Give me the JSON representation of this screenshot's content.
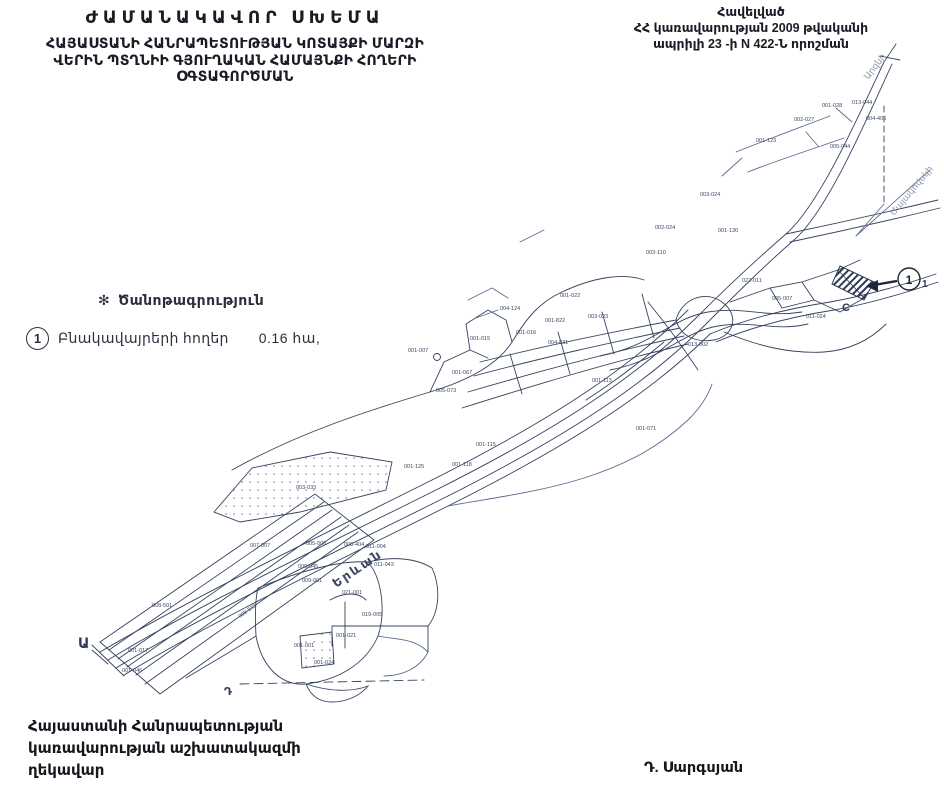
{
  "header": {
    "title_lines": [
      "ԺԱՄԱՆԱԿԱՎՈՐ ՍԽԵՄԱ",
      "ՀԱՅԱՍՏԱՆԻ ՀԱՆՐԱՊԵՏՈՒԹՅԱՆ ԿՈՏԱՅՔԻ ՄԱՐԶԻ",
      "ՎԵՐԻՆ ՊՏՂՆԻԻ ԳՅՈՒՂԱԿԱՆ ՀԱՄԱՅՆՔԻ ՀՈՂԵՐԻ",
      "ՕԳՏԱԳՈՐԾՄԱՆ"
    ]
  },
  "approval": {
    "lines": [
      "Հավելված",
      "ՀՀ կառավարության 2009 թվականի",
      "ապրիլի 23 -ի N 422-Ն որոշման"
    ]
  },
  "legend": {
    "note_symbol": "✻",
    "note_title": "Ծանոթագրություն",
    "item_marker": "1",
    "item_label": "Բնակավայրերի հողեր",
    "item_value": "0.16 հա,"
  },
  "footer": {
    "left_lines": [
      "Հայաստանի Հանրապետության",
      "կառավարության աշխատակազմի",
      "ղեկավար"
    ],
    "signature": "Դ. Սարգսյան"
  },
  "map": {
    "ink_color": "#36435f",
    "light_ink_color": "#7484a6",
    "labels": [
      {
        "text": "Երևան",
        "x": 336,
        "y": 588,
        "rot": -34,
        "size": 12.5,
        "color": "#3c4560",
        "ls": 2,
        "weight": "600"
      },
      {
        "text": "Ա",
        "x": 78,
        "y": 648,
        "size": 14,
        "color": "#2e3a55",
        "weight": "600"
      },
      {
        "text": "Դ",
        "x": 224,
        "y": 695,
        "size": 11,
        "color": "#2e3a55",
        "weight": "600"
      },
      {
        "text": "C",
        "x": 842,
        "y": 311,
        "size": 11,
        "color": "#2e3a55",
        "weight": "600"
      },
      {
        "text": "1",
        "x": 909,
        "y": 284,
        "size": 12,
        "color": "#1d2638",
        "weight": "700",
        "anchor": "middle"
      },
      {
        "text": "1",
        "x": 922,
        "y": 287,
        "size": 10,
        "color": "#2e3a55",
        "weight": "600"
      },
      {
        "text": "Արզնի",
        "x": 868,
        "y": 80,
        "rot": -52,
        "size": 9,
        "color": "#8a97b5"
      },
      {
        "text": "Մայակովսկի",
        "x": 894,
        "y": 216,
        "rot": -50,
        "size": 9,
        "color": "#8a97b5"
      }
    ],
    "parcel_codes": [
      {
        "t": "001-123",
        "x": 756,
        "y": 142
      },
      {
        "t": "002-027",
        "x": 794,
        "y": 121
      },
      {
        "t": "001-028",
        "x": 822,
        "y": 107
      },
      {
        "t": "013-044",
        "x": 852,
        "y": 104
      },
      {
        "t": "005-044",
        "x": 830,
        "y": 148
      },
      {
        "t": "004-405",
        "x": 866,
        "y": 120
      },
      {
        "t": "003-024",
        "x": 700,
        "y": 196
      },
      {
        "t": "001-130",
        "x": 718,
        "y": 232
      },
      {
        "t": "002-024",
        "x": 655,
        "y": 229
      },
      {
        "t": "003-110",
        "x": 646,
        "y": 254
      },
      {
        "t": "001-022",
        "x": 560,
        "y": 297
      },
      {
        "t": "001-822",
        "x": 545,
        "y": 322
      },
      {
        "t": "003-023",
        "x": 588,
        "y": 318
      },
      {
        "t": "004-031",
        "x": 548,
        "y": 344
      },
      {
        "t": "001-016",
        "x": 516,
        "y": 334
      },
      {
        "t": "001-015",
        "x": 470,
        "y": 340
      },
      {
        "t": "004-124",
        "x": 500,
        "y": 310
      },
      {
        "t": "005-073",
        "x": 436,
        "y": 392
      },
      {
        "t": "001-007",
        "x": 408,
        "y": 352
      },
      {
        "t": "001-067",
        "x": 452,
        "y": 374
      },
      {
        "t": "001-113",
        "x": 592,
        "y": 382
      },
      {
        "t": "013-002",
        "x": 688,
        "y": 346
      },
      {
        "t": "022-011",
        "x": 742,
        "y": 282
      },
      {
        "t": "005-007",
        "x": 772,
        "y": 300
      },
      {
        "t": "011-024",
        "x": 806,
        "y": 318
      },
      {
        "t": "001-071",
        "x": 636,
        "y": 430
      },
      {
        "t": "001-115",
        "x": 476,
        "y": 446
      },
      {
        "t": "001-118",
        "x": 452,
        "y": 466
      },
      {
        "t": "001-125",
        "x": 404,
        "y": 468
      },
      {
        "t": "003-033",
        "x": 296,
        "y": 489
      },
      {
        "t": "008-533",
        "x": 240,
        "y": 618,
        "rot": -35
      },
      {
        "t": "008-501",
        "x": 152,
        "y": 607
      },
      {
        "t": "001-017",
        "x": 128,
        "y": 652
      },
      {
        "t": "001-046",
        "x": 122,
        "y": 672
      },
      {
        "t": "005-006",
        "x": 306,
        "y": 545
      },
      {
        "t": "008-404",
        "x": 344,
        "y": 546
      },
      {
        "t": "007-007",
        "x": 250,
        "y": 547
      },
      {
        "t": "009-045",
        "x": 298,
        "y": 568
      },
      {
        "t": "009-001",
        "x": 302,
        "y": 582
      },
      {
        "t": "011-004",
        "x": 366,
        "y": 548
      },
      {
        "t": "011-043",
        "x": 374,
        "y": 566
      },
      {
        "t": "021-001",
        "x": 342,
        "y": 594
      },
      {
        "t": "019-005",
        "x": 362,
        "y": 616
      },
      {
        "t": "001-021",
        "x": 336,
        "y": 637
      },
      {
        "t": "001-001",
        "x": 294,
        "y": 647
      },
      {
        "t": "001-024",
        "x": 314,
        "y": 664
      }
    ]
  }
}
